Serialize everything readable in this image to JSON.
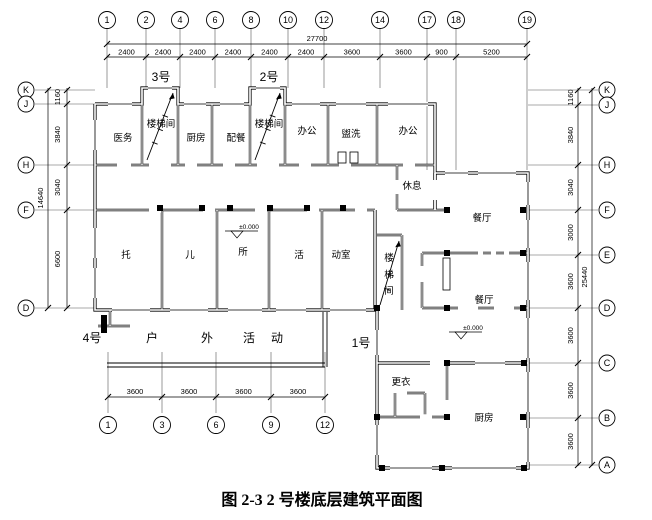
{
  "figure": {
    "caption": "图 2-3 2 号楼底层建筑平面图"
  },
  "axes": {
    "top": {
      "labels": [
        "1",
        "2",
        "4",
        "6",
        "8",
        "10",
        "12",
        "14",
        "17",
        "18",
        "19"
      ],
      "total": "27700",
      "segments": [
        "2400",
        "2400",
        "2400",
        "2400",
        "2400",
        "2400",
        "3600",
        "3600",
        "900",
        "5200"
      ]
    },
    "bottom": {
      "labels": [
        "1",
        "3",
        "6",
        "9",
        "12"
      ],
      "segments": [
        "3600",
        "3600",
        "3600",
        "3600"
      ]
    },
    "left": {
      "labels": [
        "K",
        "J",
        "H",
        "F",
        "D"
      ],
      "total": "14640",
      "segments": [
        "1160",
        "3840",
        "3040",
        "6600"
      ]
    },
    "right": {
      "labels": [
        "K",
        "J",
        "H",
        "F",
        "E",
        "D",
        "C",
        "B",
        "A"
      ],
      "total": "25440",
      "segments": [
        "1160",
        "3840",
        "3040",
        "3000",
        "3600",
        "3600",
        "3600",
        "3600"
      ]
    }
  },
  "units": {
    "u3": "3号",
    "u2": "2号",
    "u4": "4号",
    "u1": "1号"
  },
  "rooms": {
    "yiwu": "医务",
    "stair_a": "楼梯间",
    "chufang": "厨房",
    "peican": "配餐",
    "stair_b": "楼梯间",
    "bangong_a": "办公",
    "guanxi": "盥洗",
    "bangong_b": "办公",
    "xiuxi": "休息",
    "tuo": "托",
    "er": "儿",
    "suo": "所",
    "huo": "活",
    "dongshi": "动室",
    "stair_c1": "楼",
    "stair_c2": "梯",
    "stair_c3": "间",
    "canting_a": "餐厅",
    "canting_b": "餐厅",
    "gengyi": "更衣",
    "chufang_b": "厨房"
  },
  "outdoor": [
    "户",
    "外",
    "活",
    "动"
  ],
  "levels": {
    "main": "±0.000",
    "dining": "±0.000"
  }
}
